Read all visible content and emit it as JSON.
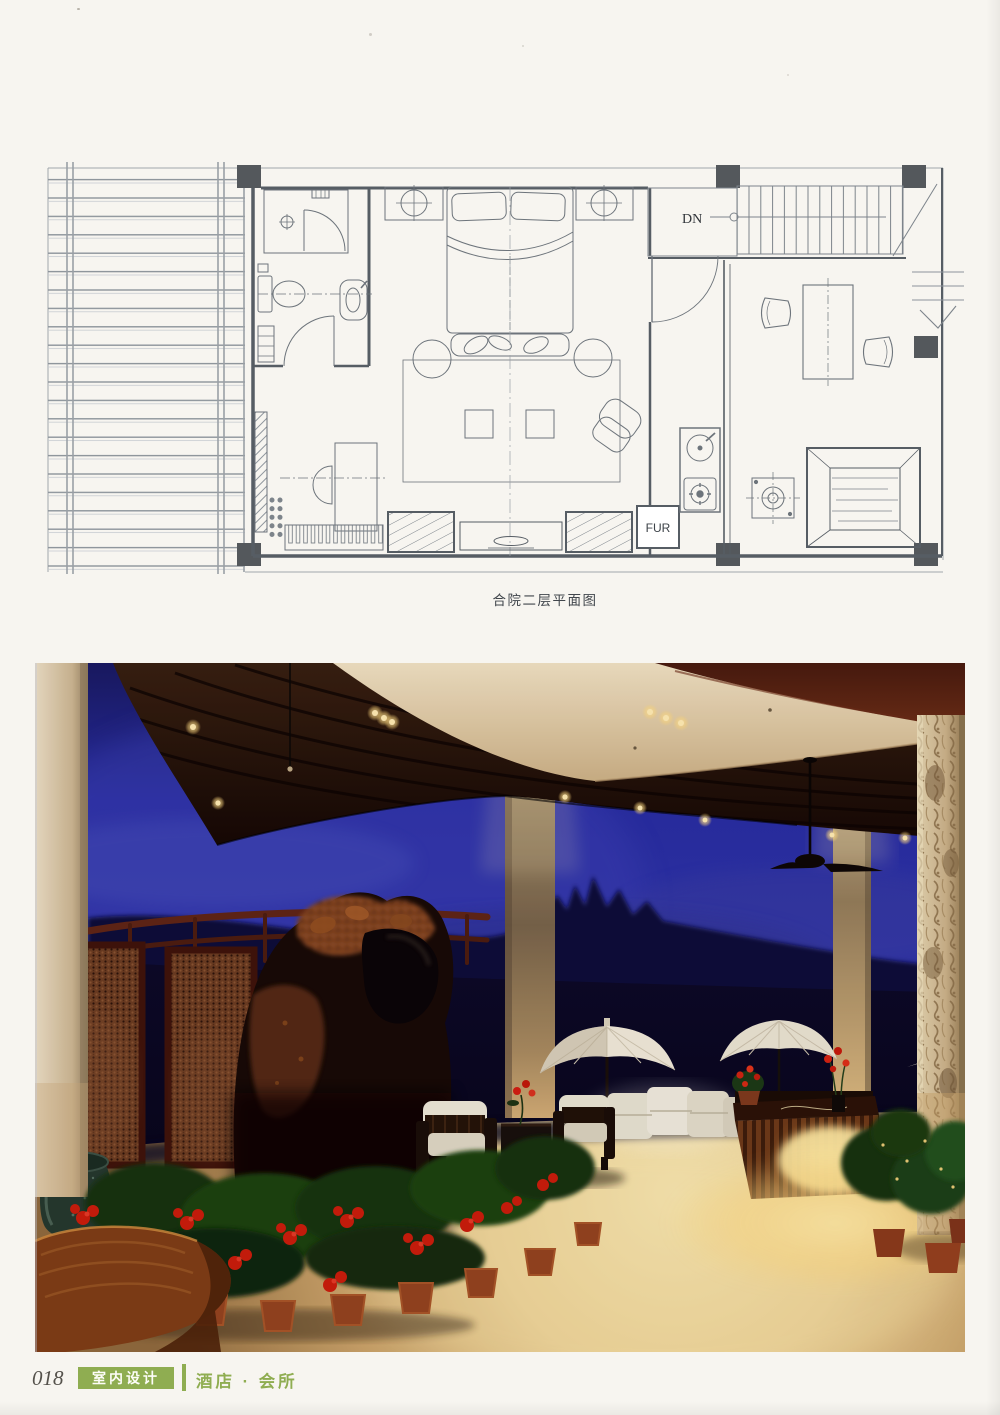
{
  "floor_plan": {
    "caption": "合院二层平面图",
    "labels": {
      "down": "DN",
      "furniture": "FUR"
    }
  },
  "footer": {
    "page_number": "018",
    "category_badge": "室内设计",
    "section_title": "酒店 · 会所"
  },
  "colors": {
    "accent_green": "#8fad51",
    "plan_ink": "#6c737a",
    "sky_blue": "#2b31a2",
    "wood_dark": "#241106",
    "cream_stone": "#e6d6b4",
    "floor_gold": "#e7cb8b",
    "flower_red": "#c91d0a"
  }
}
